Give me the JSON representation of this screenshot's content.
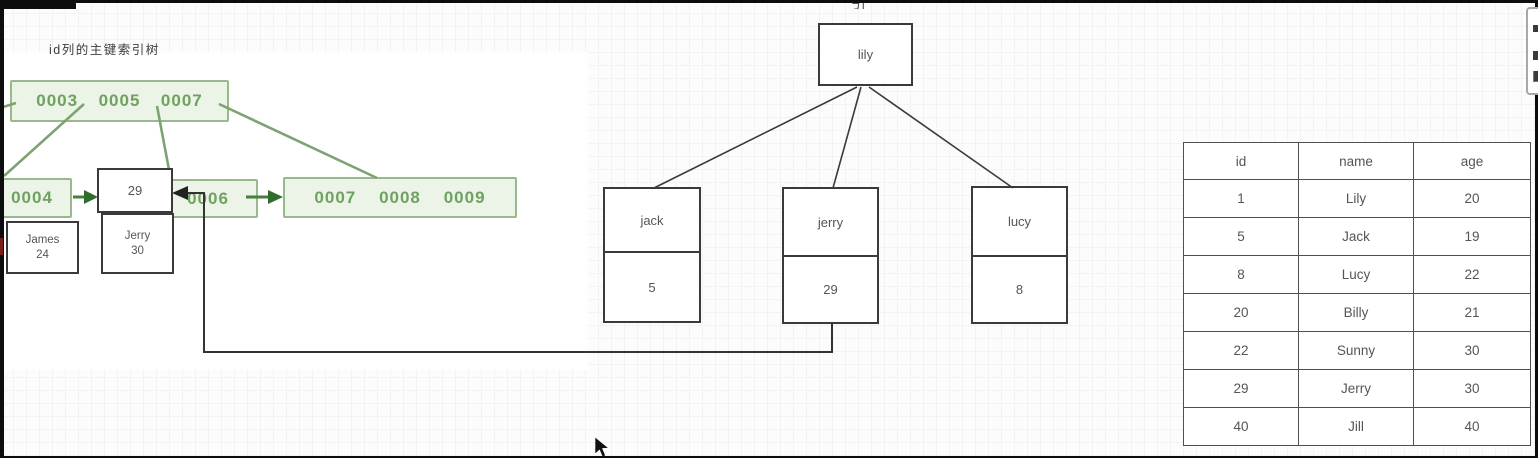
{
  "title": "id列的主键索引树",
  "clipped_label": "引",
  "index_tree": {
    "root_keys": [
      "0003",
      "0005",
      "0007"
    ],
    "leaf1_key": "0004",
    "leaf2_key": "0006",
    "leaf3_keys": [
      "0007",
      "0008",
      "0009"
    ]
  },
  "records": {
    "key_box": "29",
    "james": {
      "name": "James",
      "age": "24"
    },
    "jerry": {
      "name": "Jerry",
      "age": "30"
    }
  },
  "name_tree": {
    "root": "lily",
    "children": [
      {
        "name": "jack",
        "key": "5"
      },
      {
        "name": "jerry",
        "key": "29"
      },
      {
        "name": "lucy",
        "key": "8"
      }
    ]
  },
  "table": {
    "headers": [
      "id",
      "name",
      "age"
    ],
    "rows": [
      [
        "1",
        "Lily",
        "20"
      ],
      [
        "5",
        "Jack",
        "19"
      ],
      [
        "8",
        "Lucy",
        "22"
      ],
      [
        "20",
        "Billy",
        "21"
      ],
      [
        "22",
        "Sunny",
        "30"
      ],
      [
        "29",
        "Jerry",
        "30"
      ],
      [
        "40",
        "Jill",
        "40"
      ]
    ]
  },
  "colors": {
    "green_fill": "#ebf4e6",
    "green_border": "#9ab88d",
    "green_text": "#6fa161",
    "green_line": "#7da371",
    "green_arrow": "#2f6e2c",
    "dark_line": "#3a3a3a",
    "table_border": "#4f4f4f",
    "text_gray": "#555555"
  }
}
